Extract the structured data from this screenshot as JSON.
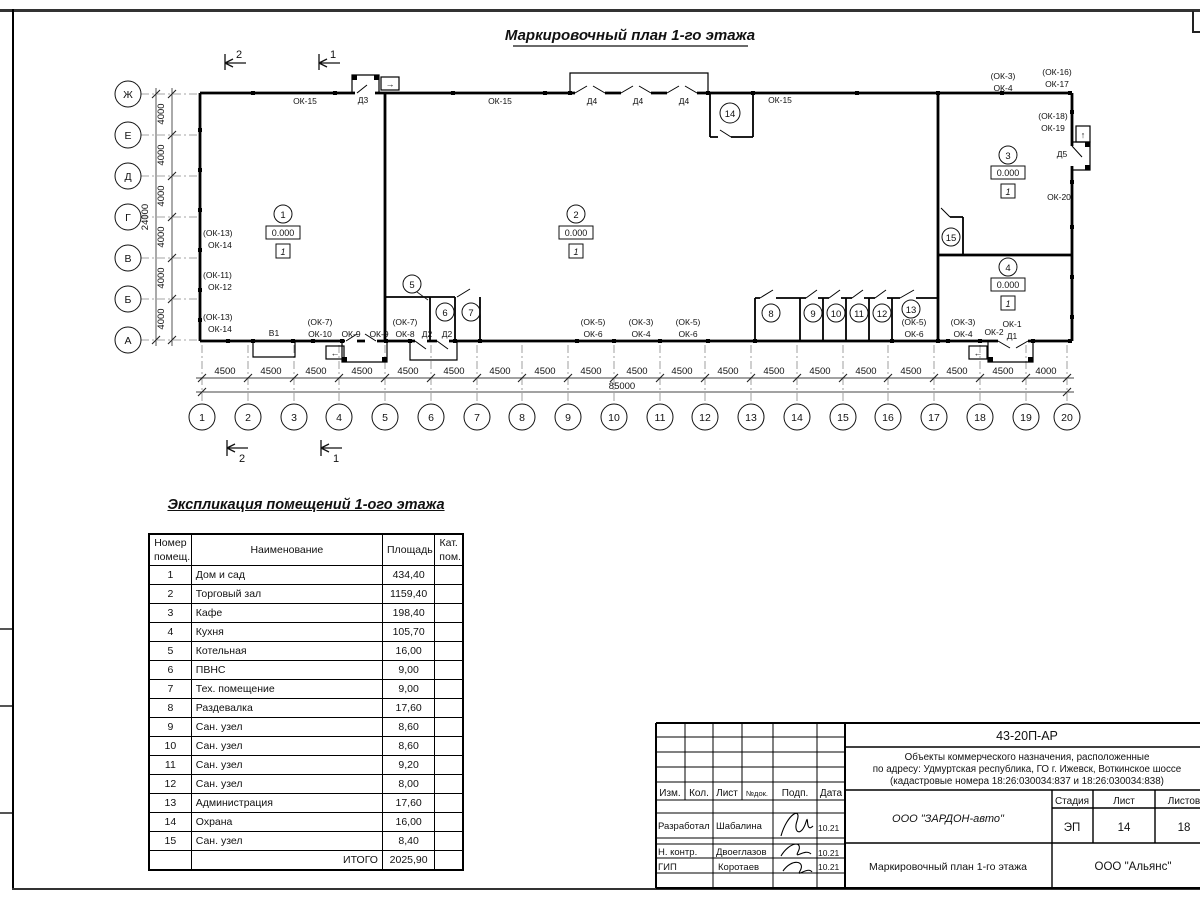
{
  "plan": {
    "title": "Маркировочный план 1-го этажа",
    "section_cut_1": "1",
    "section_cut_2": "2",
    "axes_left": [
      "Ж",
      "Е",
      "Д",
      "Г",
      "В",
      "Б",
      "А"
    ],
    "axes_bottom": [
      "1",
      "2",
      "3",
      "4",
      "5",
      "6",
      "7",
      "8",
      "9",
      "10",
      "11",
      "12",
      "13",
      "14",
      "15",
      "16",
      "17",
      "18",
      "19",
      "20"
    ],
    "dims": {
      "bay": "4500",
      "end_bay": "4000",
      "total": "85000",
      "left_bay": "4000",
      "left_total": "24000"
    },
    "wall_labels": [
      "ОК-15",
      "Д3",
      "ОК-15",
      "Д4",
      "Д4",
      "Д4",
      "ОК-15",
      "(ОК-3)",
      "ОК-4",
      "(ОК-16)",
      "ОК-17",
      "(ОК-18)",
      "ОК-19",
      "Д5",
      "ОК-20",
      "(ОК-13)",
      "ОК-14",
      "(ОК-11)",
      "ОК-12",
      "(ОК-13)",
      "ОК-14",
      "В1",
      "(ОК-7)",
      "ОК-10",
      "ОК-9",
      "ОК-9",
      "(ОК-7)",
      "ОК-8",
      "Д2",
      "Д2",
      "(ОК-5)",
      "ОК-6",
      "(ОК-3)",
      "ОК-4",
      "(ОК-5)",
      "ОК-6",
      "(ОК-5)",
      "ОК-6",
      "(ОК-3)",
      "ОК-4",
      "ОК-2",
      "ОК-1",
      "Д1"
    ],
    "room_marks": [
      {
        "num": "1",
        "level": "0.000",
        "floor_type": "1"
      },
      {
        "num": "2",
        "level": "0.000",
        "floor_type": "1"
      },
      {
        "num": "3",
        "level": "0.000",
        "floor_type": "1"
      },
      {
        "num": "4",
        "level": "0.000",
        "floor_type": "1"
      }
    ],
    "room_numbers": [
      "5",
      "6",
      "7",
      "8",
      "9",
      "10",
      "11",
      "12",
      "13",
      "14",
      "15"
    ],
    "exit_arrow_right": "→",
    "exit_arrow_up": "↑",
    "exit_arrow_left": "←"
  },
  "table": {
    "title": "Экспликация помещений 1-ого этажа",
    "headers": {
      "num": "Номер\nпомещ.",
      "name": "Наименование",
      "area": "Площадь",
      "cat": "Кат.\nпом."
    },
    "rows": [
      [
        "1",
        "Дом и сад",
        "434,40"
      ],
      [
        "2",
        "Торговый зал",
        "1159,40"
      ],
      [
        "3",
        "Кафе",
        "198,40"
      ],
      [
        "4",
        "Кухня",
        "105,70"
      ],
      [
        "5",
        "Котельная",
        "16,00"
      ],
      [
        "6",
        "ПВНС",
        "9,00"
      ],
      [
        "7",
        "Тех. помещение",
        "9,00"
      ],
      [
        "8",
        "Раздевалка",
        "17,60"
      ],
      [
        "9",
        "Сан. узел",
        "8,60"
      ],
      [
        "10",
        "Сан. узел",
        "8,60"
      ],
      [
        "11",
        "Сан. узел",
        "9,20"
      ],
      [
        "12",
        "Сан. узел",
        "8,00"
      ],
      [
        "13",
        "Администрация",
        "17,60"
      ],
      [
        "14",
        "Охрана",
        "16,00"
      ],
      [
        "15",
        "Сан. узел",
        "8,40"
      ]
    ],
    "total_label": "ИТОГО",
    "total_value": "2025,90"
  },
  "titleblock": {
    "doc_number": "43-20П-АР",
    "project_line1": "Объекты коммерческого назначения, расположенные",
    "project_line2": "по адресу: Удмуртская республика, ГО г. Ижевск, Воткинское шоссе",
    "project_line3": "(кадастровые номера 18:26:030034:837 и 18:26:030034:838)",
    "cols": {
      "izm": "Изм.",
      "kol": "Кол.",
      "list": "Лист",
      "ndok": "№док.",
      "podp": "Подп.",
      "data": "Дата"
    },
    "roles": [
      {
        "role": "Разработал",
        "name": "Шабалина",
        "date": "10.21"
      },
      {
        "role": "Н. контр.",
        "name": "Двоеглазов",
        "date": "10.21"
      },
      {
        "role": "ГИП",
        "name": "Коротаев",
        "date": "10.21"
      }
    ],
    "org": "ООО \"ЗАРДОН-авто\"",
    "stage_label": "Стадия",
    "sheet_label": "Лист",
    "sheets_label": "Листов",
    "stage": "ЭП",
    "sheet": "14",
    "sheets": "18",
    "drawing_name": "Маркировочный план 1-го этажа",
    "company": "ООО \"Альянс\""
  }
}
